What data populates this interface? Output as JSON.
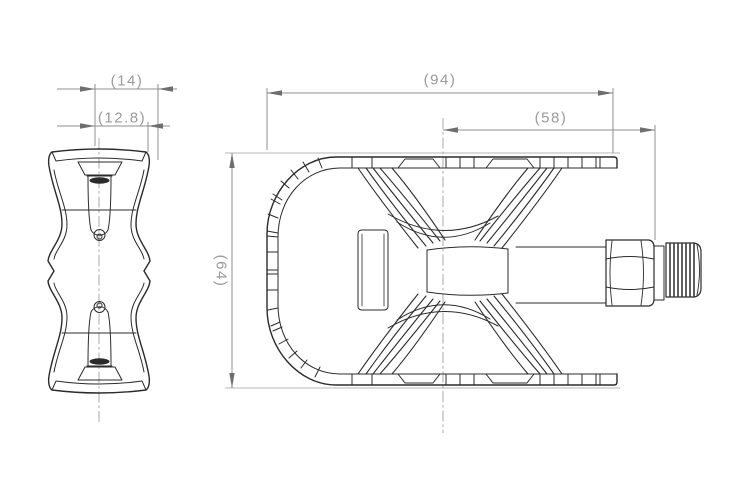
{
  "dimensions": {
    "d14": "(14)",
    "d12_8": "(12.8)",
    "d94": "(94)",
    "d58": "(58)",
    "d64": "(64)"
  },
  "colors": {
    "background": "#ffffff",
    "part_line": "#2b2b2b",
    "dimension_line": "#8f8f8f",
    "arrow": "#6e6e6e",
    "dimension_text": "#9a9a9a",
    "centerline": "#a8a8a8",
    "ground_line": "#c5c5c5"
  }
}
